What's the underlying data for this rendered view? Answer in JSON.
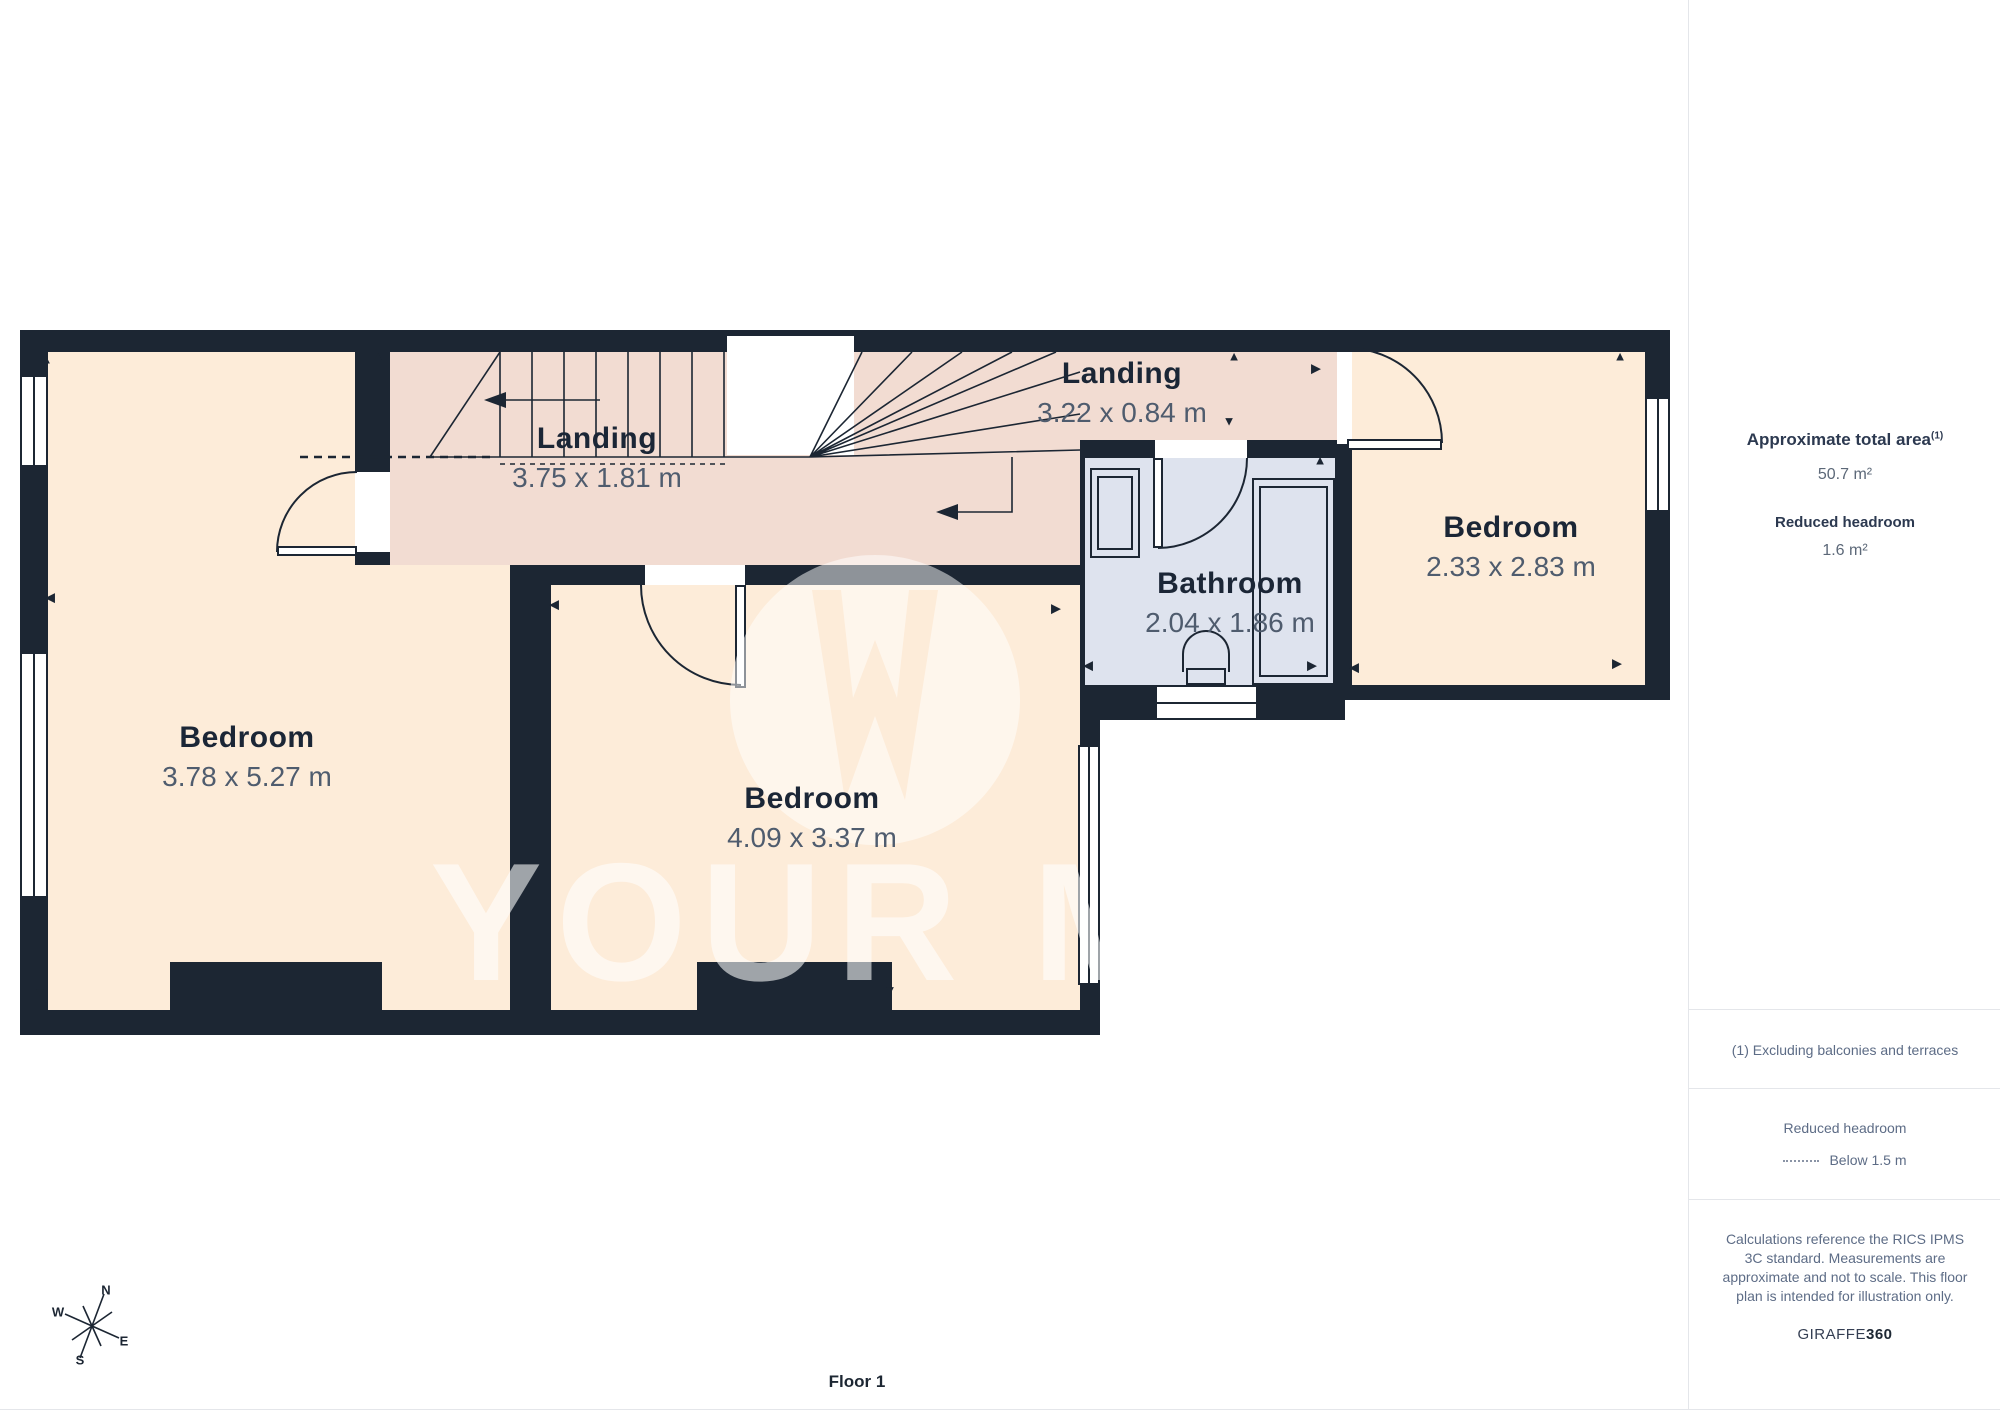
{
  "plan": {
    "floor_label": "Floor 1",
    "watermark": "YOUR MOVE",
    "rooms": {
      "left_bedroom": {
        "name": "Bedroom",
        "dims": "3.78 x 5.27 m"
      },
      "main_landing": {
        "name": "Landing",
        "dims": "3.75 x 1.81 m"
      },
      "east_landing": {
        "name": "Landing",
        "dims": "3.22 x 0.84 m"
      },
      "bathroom": {
        "name": "Bathroom",
        "dims": "2.04 x 1.86 m"
      },
      "middle_bedroom": {
        "name": "Bedroom",
        "dims": "4.09 x 3.37 m"
      },
      "right_bedroom": {
        "name": "Bedroom",
        "dims": "2.33 x 2.83 m"
      }
    },
    "compass": {
      "n": "N",
      "e": "E",
      "s": "S",
      "w": "W"
    },
    "markers": [
      {
        "g": "▲",
        "x": 46,
        "y": 359
      },
      {
        "g": "▼",
        "x": 40,
        "y": 992
      },
      {
        "g": "◀",
        "x": 50,
        "y": 597
      },
      {
        "g": "▲",
        "x": 378,
        "y": 356
      },
      {
        "g": "◀",
        "x": 554,
        "y": 604
      },
      {
        "g": "▶",
        "x": 1056,
        "y": 608
      },
      {
        "g": "▼",
        "x": 890,
        "y": 990
      },
      {
        "g": "▲",
        "x": 1234,
        "y": 356
      },
      {
        "g": "▼",
        "x": 1229,
        "y": 421
      },
      {
        "g": "▶",
        "x": 1316,
        "y": 368
      },
      {
        "g": "▲",
        "x": 1320,
        "y": 460
      },
      {
        "g": "◀",
        "x": 1088,
        "y": 665
      },
      {
        "g": "▶",
        "x": 1312,
        "y": 665
      },
      {
        "g": "▲",
        "x": 1620,
        "y": 356
      },
      {
        "g": "▶",
        "x": 1617,
        "y": 663
      },
      {
        "g": "◀",
        "x": 1354,
        "y": 667
      }
    ]
  },
  "sidebar": {
    "total_area_label": "Approximate total area",
    "total_area_superscript": "(1)",
    "total_area_value": "50.7 m²",
    "reduced_headroom_label": "Reduced headroom",
    "reduced_headroom_value": "1.6 m²",
    "footnote": "(1) Excluding balconies and terraces",
    "legend_title": "Reduced headroom",
    "legend_value": "Below 1.5 m",
    "disclaimer": "Calculations reference the RICS IPMS 3C standard. Measurements are approximate and not to scale. This floor plan is intended for illustration only.",
    "brand": "GIRAFFE",
    "brand_suffix": "360"
  },
  "colors": {
    "wall": "#1c2633",
    "bedroom_fill": "#fdecd9",
    "landing_fill": "#f2dcd2",
    "bathroom_fill": "#dee3ee",
    "dimension_text": "#4f5c6e",
    "note_text": "#5d6c86"
  }
}
